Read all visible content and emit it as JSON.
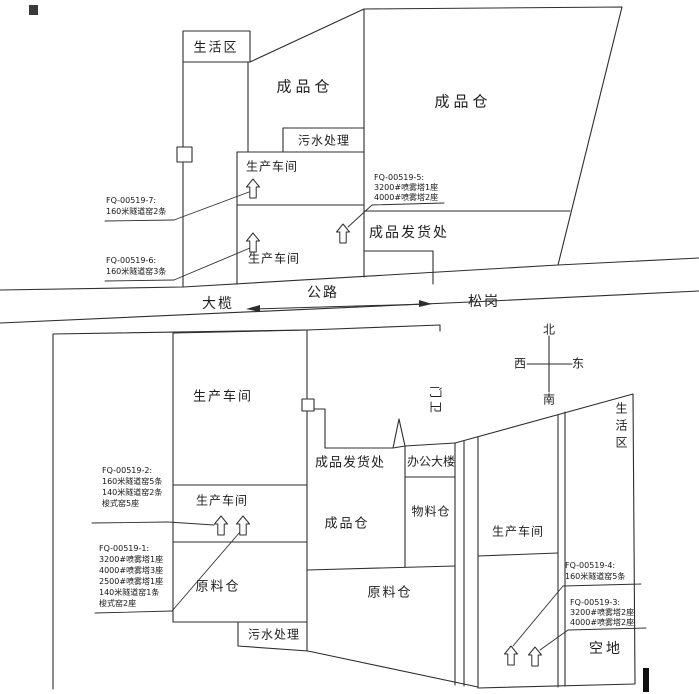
{
  "upper_site": {
    "living_area": "生活区",
    "finished_goods_warehouse_left": "成品仓",
    "finished_goods_warehouse_right": "成品仓",
    "sewage_treatment": "污水处理",
    "workshop_upper": "生产车间",
    "workshop_lower": "生产车间",
    "shipping_area": "成品发货处"
  },
  "road": {
    "left_destination": "大榄",
    "road_label": "公路",
    "right_destination": "松岗"
  },
  "compass": {
    "north": "北",
    "south": "南",
    "west": "西",
    "east": "东"
  },
  "lower_site": {
    "workshop_main": "生产车间",
    "workshop_small": "生产车间",
    "raw_material_warehouse_left": "原料仓",
    "sewage_treatment": "污水处理",
    "shipping_area": "成品发货处",
    "office_building": "办公大楼",
    "finished_goods_warehouse": "成品仓",
    "material_warehouse": "物料仓",
    "raw_material_warehouse_right": "原料仓",
    "gate_house": "门卫",
    "workshop_right": "生产车间",
    "living_area": "生活区",
    "empty_lot": "空地"
  },
  "annotations": {
    "fq7": {
      "title": "FQ-00519-7:",
      "lines": [
        "160米隧道窑2条"
      ]
    },
    "fq6": {
      "title": "FQ-00519-6:",
      "lines": [
        "160米隧道窑3条"
      ]
    },
    "fq5": {
      "title": "FQ-00519-5:",
      "lines": [
        "3200#喷雾塔1座",
        "4000#喷雾塔2座"
      ]
    },
    "fq2": {
      "title": "FQ-00519-2:",
      "lines": [
        "160米隧道窑5条",
        "140米隧道窑2条",
        "梭式窑5座"
      ]
    },
    "fq1": {
      "title": "FQ-00519-1:",
      "lines": [
        "3200#喷雾塔1座",
        "4000#喷雾塔3座",
        "2500#喷雾塔1座",
        "140米隧道窑1条",
        "梭式窑2座"
      ]
    },
    "fq4": {
      "title": "FQ-00519-4:",
      "lines": [
        "160米隧道窑5条"
      ]
    },
    "fq3": {
      "title": "FQ-00519-3:",
      "lines": [
        "3200#喷雾塔2座",
        "4000#喷雾塔2座"
      ]
    }
  },
  "colors": {
    "line": "#2e2e2e",
    "background": "#ffffff"
  }
}
